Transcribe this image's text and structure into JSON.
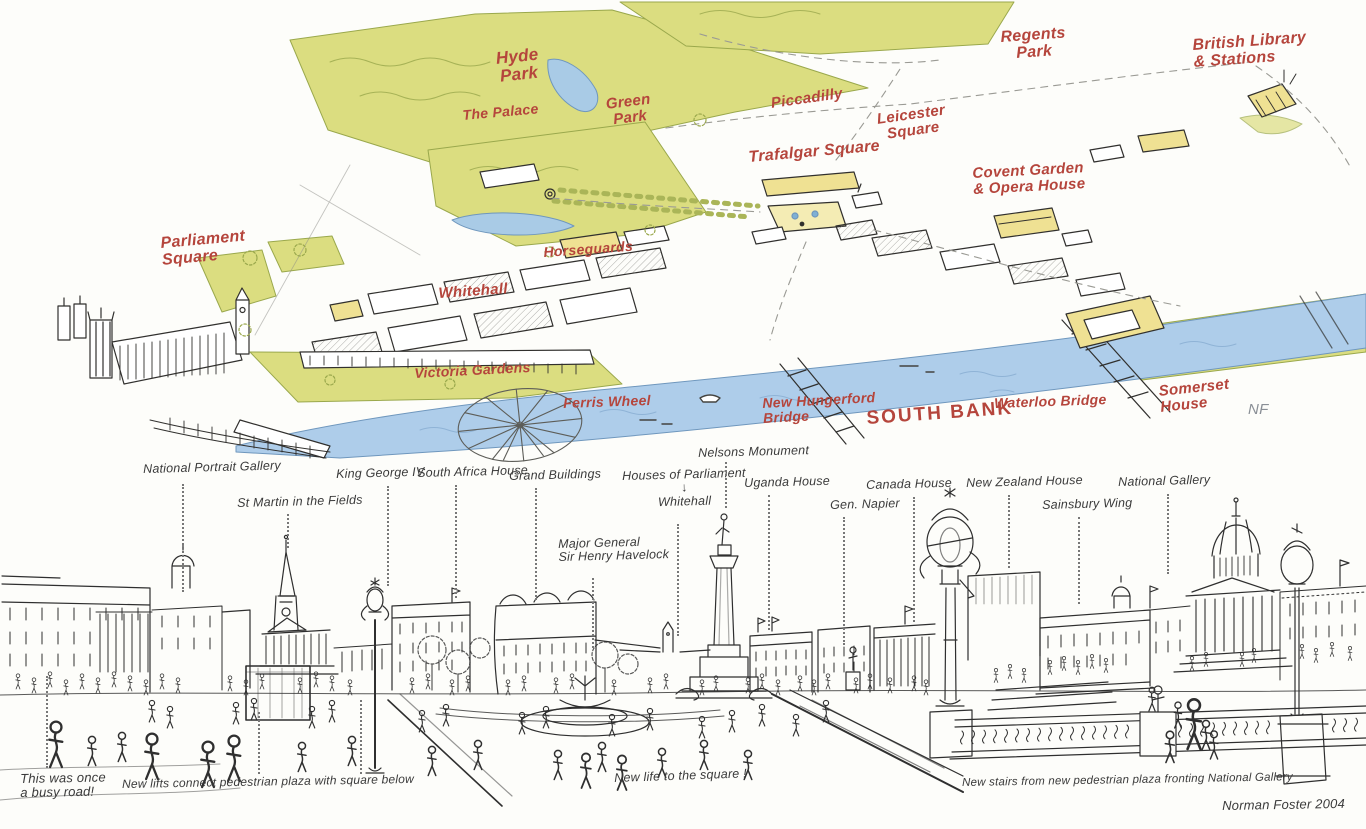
{
  "colors": {
    "paper": "#fdfdfa",
    "ink": "#30302d",
    "red_label": "#b5453c",
    "park_green": "#dbdd80",
    "water_blue": "#aecdea",
    "building_yellow": "#efe193",
    "leader_gray": "#777777"
  },
  "map": {
    "labels": [
      {
        "id": "hyde-park",
        "text": "Hyde\nPark",
        "x": 495,
        "y": 50,
        "size": 17,
        "rot": -6,
        "align": "center"
      },
      {
        "id": "the-palace",
        "text": "The Palace",
        "x": 462,
        "y": 108,
        "size": 14,
        "rot": -5
      },
      {
        "id": "green-park",
        "text": "Green\nPark",
        "x": 605,
        "y": 97,
        "size": 15,
        "rot": -7,
        "align": "center"
      },
      {
        "id": "piccadilly",
        "text": "Piccadilly",
        "x": 770,
        "y": 96,
        "size": 15,
        "rot": -8
      },
      {
        "id": "leicester-square",
        "text": "Leicester\nSquare",
        "x": 876,
        "y": 112,
        "size": 15,
        "rot": -8,
        "align": "center"
      },
      {
        "id": "trafalgar-square",
        "text": "Trafalgar Square",
        "x": 748,
        "y": 150,
        "size": 16,
        "rot": -5
      },
      {
        "id": "covent-garden-opera-house",
        "text": "Covent Garden\n& Opera House",
        "x": 972,
        "y": 166,
        "size": 15,
        "rot": -3
      },
      {
        "id": "regents-park",
        "text": "Regents\nPark",
        "x": 1000,
        "y": 30,
        "size": 16,
        "rot": -4,
        "align": "center"
      },
      {
        "id": "british-library-stations",
        "text": "British Library\n& Stations",
        "x": 1192,
        "y": 38,
        "size": 16,
        "rot": -4
      },
      {
        "id": "parliament-square",
        "text": "Parliament\nSquare",
        "x": 160,
        "y": 236,
        "size": 16,
        "rot": -5
      },
      {
        "id": "horseguards",
        "text": "Horseguards",
        "x": 543,
        "y": 245,
        "size": 14,
        "rot": -4
      },
      {
        "id": "whitehall",
        "text": "Whitehall",
        "x": 438,
        "y": 286,
        "size": 15,
        "rot": -4
      },
      {
        "id": "victoria-gardens",
        "text": "Victoria Gardens",
        "x": 414,
        "y": 366,
        "size": 14,
        "rot": -3
      },
      {
        "id": "ferris-wheel",
        "text": "Ferris Wheel",
        "x": 563,
        "y": 396,
        "size": 14,
        "rot": -2
      },
      {
        "id": "new-hungerford-bridge",
        "text": "New Hungerford\nBridge",
        "x": 762,
        "y": 396,
        "size": 14,
        "rot": -3
      },
      {
        "id": "south-bank",
        "text": "SOUTH BANK",
        "x": 866,
        "y": 409,
        "size": 19,
        "rot": -4,
        "ls": 2,
        "fs": "normal"
      },
      {
        "id": "waterloo-bridge",
        "text": "Waterloo Bridge",
        "x": 994,
        "y": 396,
        "size": 14,
        "rot": -2
      },
      {
        "id": "somerset-house",
        "text": "Somerset\nHouse",
        "x": 1158,
        "y": 384,
        "size": 15,
        "rot": -6
      },
      {
        "id": "artist-initials",
        "text": "NF",
        "x": 1248,
        "y": 402,
        "size": 15,
        "rot": 0,
        "cls": "ink"
      }
    ]
  },
  "panorama": {
    "labels": [
      {
        "id": "national-portrait-gallery",
        "text": "National Portrait Gallery",
        "x": 143,
        "y": 463,
        "leaders": [
          {
            "x": 182,
            "y1": 484,
            "y2": 592
          }
        ]
      },
      {
        "id": "st-martin-in-the-fields",
        "text": "St Martin in the Fields",
        "x": 237,
        "y": 497,
        "leaders": [
          {
            "x": 287,
            "y1": 514,
            "y2": 548
          }
        ]
      },
      {
        "id": "king-george-iv",
        "text": "King George IV",
        "x": 336,
        "y": 468,
        "leaders": [
          {
            "x": 387,
            "y1": 486,
            "y2": 586
          }
        ]
      },
      {
        "id": "south-africa-house",
        "text": "South Africa House",
        "x": 417,
        "y": 467,
        "leaders": [
          {
            "x": 455,
            "y1": 485,
            "y2": 598
          }
        ]
      },
      {
        "id": "grand-buildings",
        "text": "Grand Buildings",
        "x": 509,
        "y": 470,
        "leaders": [
          {
            "x": 535,
            "y1": 488,
            "y2": 600
          }
        ]
      },
      {
        "id": "major-general-sir-henry-havelock",
        "text": "Major General\nSir Henry Havelock",
        "x": 558,
        "y": 538,
        "leaders": [
          {
            "x": 592,
            "y1": 578,
            "y2": 648
          }
        ]
      },
      {
        "id": "houses-of-parliament-whitehall",
        "text": "Houses of Parliament\n↓\nWhitehall",
        "x": 622,
        "y": 470,
        "align": "center",
        "leaders": [
          {
            "x": 677,
            "y1": 524,
            "y2": 636
          }
        ]
      },
      {
        "id": "nelsons-monument",
        "text": "Nelsons Monument",
        "x": 698,
        "y": 447,
        "leaders": [
          {
            "x": 725,
            "y1": 462,
            "y2": 508
          }
        ]
      },
      {
        "id": "uganda-house",
        "text": "Uganda House",
        "x": 744,
        "y": 477,
        "leaders": [
          {
            "x": 768,
            "y1": 495,
            "y2": 630
          }
        ]
      },
      {
        "id": "gen-napier",
        "text": "Gen. Napier",
        "x": 830,
        "y": 499,
        "leaders": [
          {
            "x": 843,
            "y1": 517,
            "y2": 645
          }
        ]
      },
      {
        "id": "canada-house",
        "text": "Canada House",
        "x": 866,
        "y": 479,
        "leaders": [
          {
            "x": 913,
            "y1": 497,
            "y2": 622
          }
        ]
      },
      {
        "id": "new-zealand-house",
        "text": "New Zealand House",
        "x": 966,
        "y": 477,
        "leaders": [
          {
            "x": 1008,
            "y1": 495,
            "y2": 568
          }
        ]
      },
      {
        "id": "sainsbury-wing",
        "text": "Sainsbury Wing",
        "x": 1042,
        "y": 499,
        "leaders": [
          {
            "x": 1078,
            "y1": 517,
            "y2": 604
          }
        ]
      },
      {
        "id": "national-gallery",
        "text": "National Gallery",
        "x": 1118,
        "y": 476,
        "leaders": [
          {
            "x": 1167,
            "y1": 494,
            "y2": 574
          }
        ]
      }
    ],
    "annotations": [
      {
        "id": "once-a-busy-road",
        "text": "This was once\na busy road!",
        "x": 20,
        "y": 772,
        "size": 13,
        "rot": -1,
        "leaders": [
          {
            "x": 46,
            "y1": 676,
            "y2": 768
          }
        ]
      },
      {
        "id": "new-lifts",
        "text": "New lifts connect pedestrian plaza with square below",
        "x": 122,
        "y": 778,
        "size": 12,
        "rot": -1,
        "leaders": [
          {
            "x": 258,
            "y1": 712,
            "y2": 774
          },
          {
            "x": 360,
            "y1": 700,
            "y2": 774
          }
        ]
      },
      {
        "id": "new-life",
        "text": "New life to the square !",
        "x": 614,
        "y": 772,
        "size": 12.5,
        "rot": -2
      },
      {
        "id": "new-stairs",
        "text": "New stairs from new pedestrian plaza fronting National Gallery",
        "x": 962,
        "y": 777,
        "size": 11.5,
        "rot": -1
      },
      {
        "id": "artist-signature",
        "text": "Norman Foster 2004",
        "x": 1222,
        "y": 799,
        "size": 13,
        "rot": -1
      }
    ]
  }
}
